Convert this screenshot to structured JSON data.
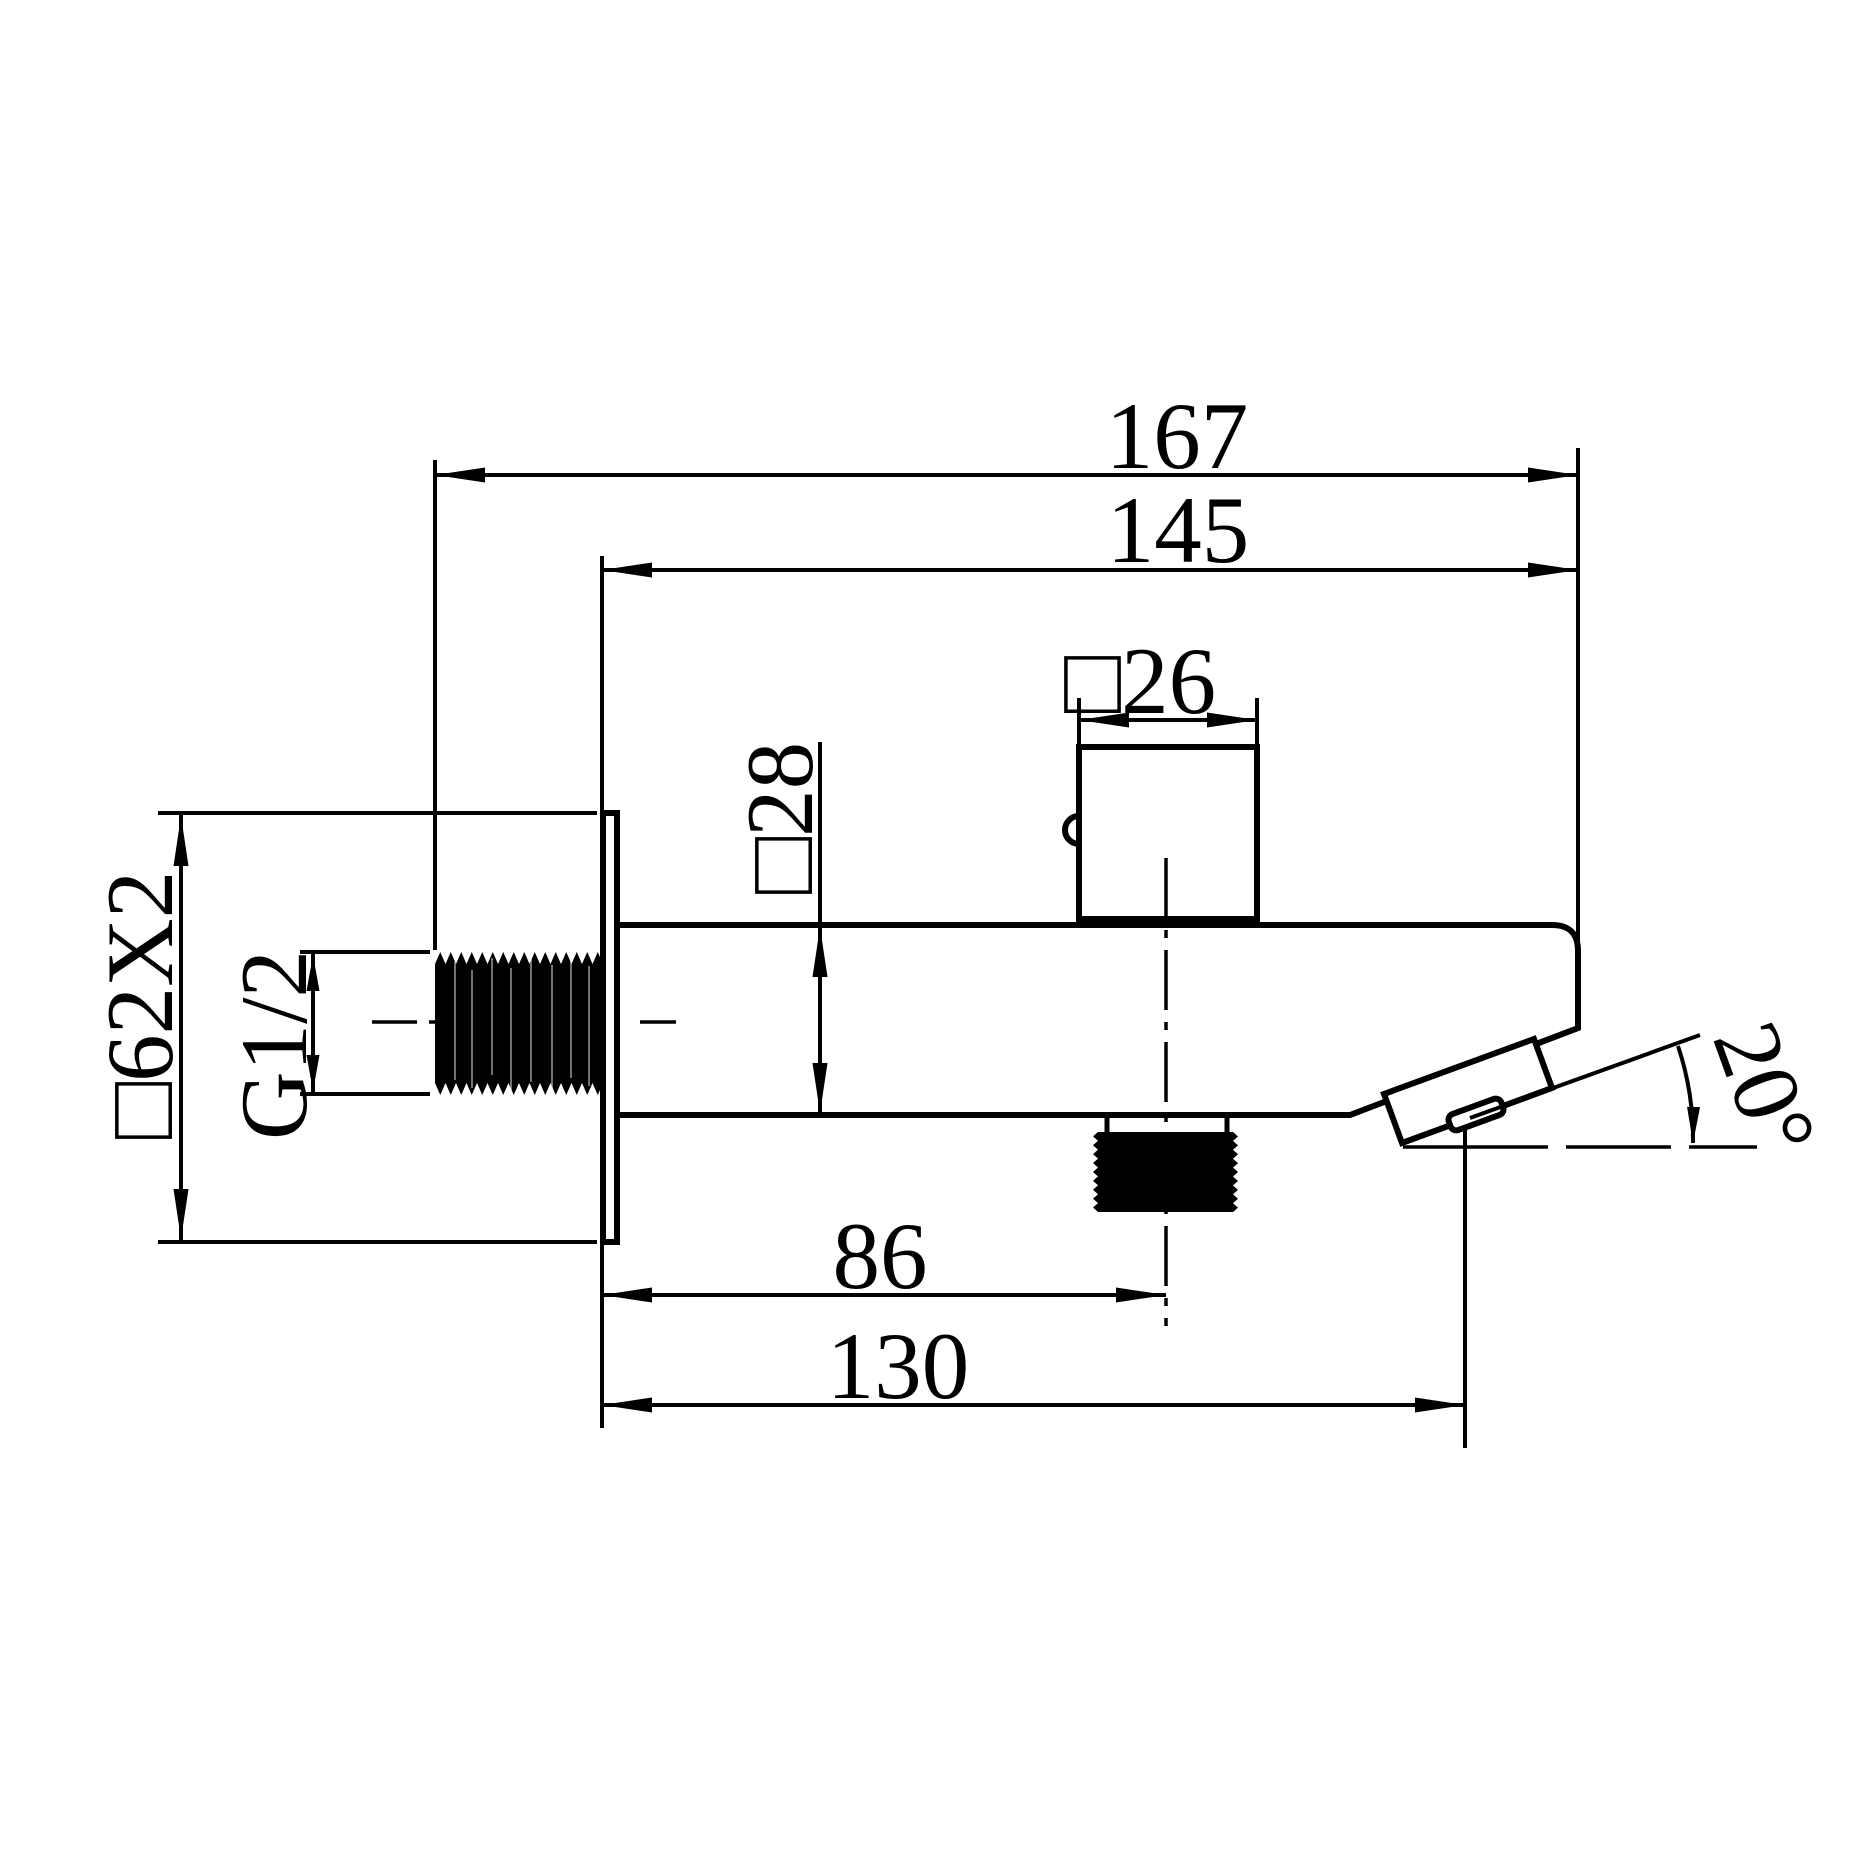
{
  "colors": {
    "ink": "#000000",
    "paper": "#ffffff"
  },
  "dimensions": {
    "overall_length": "167",
    "projection": "145",
    "handle_square": "□26",
    "body_square": "□28",
    "flange_square": "□62X2",
    "inlet_thread": "G1/2",
    "diverter_center": "86",
    "outlet_center": "130",
    "outlet_angle": "20°"
  }
}
